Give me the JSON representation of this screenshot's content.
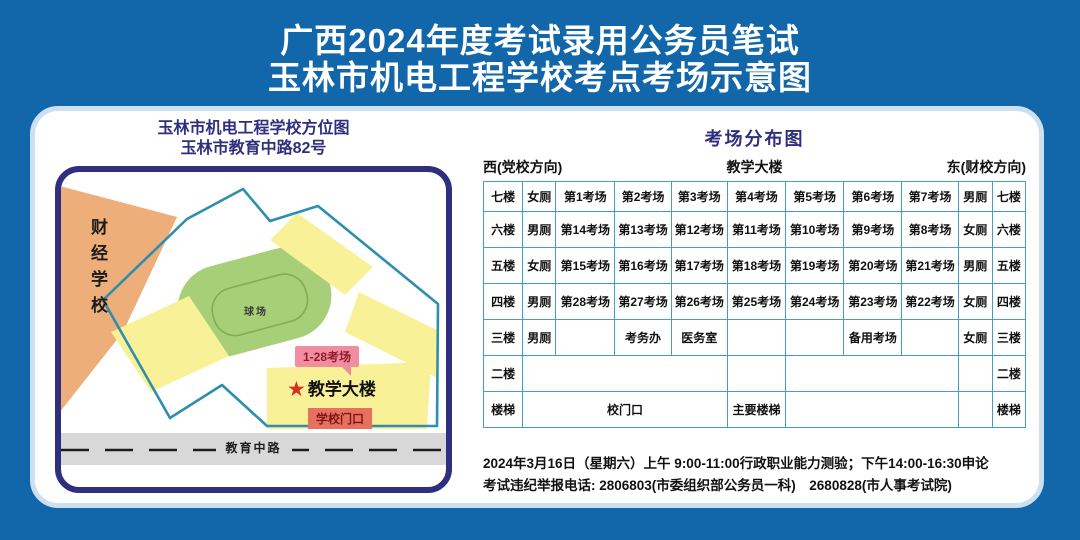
{
  "title": {
    "line1": "广西2024年度考试录用公务员笔试",
    "line2": "玉林市机电工程学校考点考场示意图"
  },
  "map": {
    "title_line1": "玉林市机电工程学校方位图",
    "title_line2": "玉林市教育中路82号",
    "neighbor_label": "财经学校",
    "field_label": "球场",
    "rooms_bubble": "1-28考场",
    "star_icon": "★",
    "building_label": "教学大楼",
    "gate_label": "学校门口",
    "road_label": "教育中路"
  },
  "distribution": {
    "title": "考场分布图",
    "west_label": "西(党校方向)",
    "center_label": "教学大楼",
    "east_label": "东(财校方向)",
    "table": {
      "rows": [
        [
          {
            "t": "七楼"
          },
          {
            "t": "女厕"
          },
          {
            "t": "第1考场"
          },
          {
            "t": "第2考场"
          },
          {
            "t": "第3考场"
          },
          {
            "t": "第4考场"
          },
          {
            "t": "第5考场"
          },
          {
            "t": "第6考场"
          },
          {
            "t": "第7考场"
          },
          {
            "t": "男厕"
          },
          {
            "t": "七楼"
          }
        ],
        [
          {
            "t": "六楼"
          },
          {
            "t": "男厕"
          },
          {
            "t": "第14考场"
          },
          {
            "t": "第13考场"
          },
          {
            "t": "第12考场"
          },
          {
            "t": "第11考场"
          },
          {
            "t": "第10考场"
          },
          {
            "t": "第9考场"
          },
          {
            "t": "第8考场"
          },
          {
            "t": "女厕"
          },
          {
            "t": "六楼"
          }
        ],
        [
          {
            "t": "五楼"
          },
          {
            "t": "女厕"
          },
          {
            "t": "第15考场"
          },
          {
            "t": "第16考场"
          },
          {
            "t": "第17考场"
          },
          {
            "t": "第18考场"
          },
          {
            "t": "第19考场"
          },
          {
            "t": "第20考场"
          },
          {
            "t": "第21考场"
          },
          {
            "t": "男厕"
          },
          {
            "t": "五楼"
          }
        ],
        [
          {
            "t": "四楼"
          },
          {
            "t": "男厕"
          },
          {
            "t": "第28考场"
          },
          {
            "t": "第27考场"
          },
          {
            "t": "第26考场"
          },
          {
            "t": "第25考场"
          },
          {
            "t": "第24考场"
          },
          {
            "t": "第23考场"
          },
          {
            "t": "第22考场"
          },
          {
            "t": "女厕"
          },
          {
            "t": "四楼"
          }
        ],
        [
          {
            "t": "三楼"
          },
          {
            "t": "男厕"
          },
          {
            "t": ""
          },
          {
            "t": "考务办"
          },
          {
            "t": "医务室"
          },
          {
            "t": ""
          },
          {
            "t": ""
          },
          {
            "t": "备用考场"
          },
          {
            "t": ""
          },
          {
            "t": "女厕"
          },
          {
            "t": "三楼"
          }
        ],
        [
          {
            "t": "二楼"
          },
          {
            "t": "",
            "span": 4
          },
          {
            "t": ""
          },
          {
            "t": "",
            "span": 3
          },
          {
            "t": ""
          },
          {
            "t": "二楼"
          }
        ],
        [
          {
            "t": "楼梯"
          },
          {
            "t": "校门口",
            "span": 4
          },
          {
            "t": "主要楼梯"
          },
          {
            "t": "",
            "span": 3
          },
          {
            "t": ""
          },
          {
            "t": "楼梯"
          }
        ]
      ]
    }
  },
  "footer": {
    "line1": "2024年3月16日（星期六）上午 9:00-11:00行政职业能力测验；下午14:00-16:30申论",
    "line2": "考试违纪举报电话: 2806803(市委组织部公务员一科)　2680828(市人事考试院)"
  },
  "colors": {
    "bg": "#1267aa",
    "navy": "#2f2f7d",
    "panel_edge": "#cde0f0",
    "table_border": "#43a0c2",
    "orange": "#eeae7a",
    "yellow": "#f9f198",
    "green": "#a6cf77",
    "green_line": "#84ad52",
    "teal": "#2e8fad",
    "road": "#d8d8d8",
    "pink": "#f08da0",
    "coral": "#e8705f",
    "label_red": "#8f1d2c",
    "star_red": "#d6301f"
  }
}
